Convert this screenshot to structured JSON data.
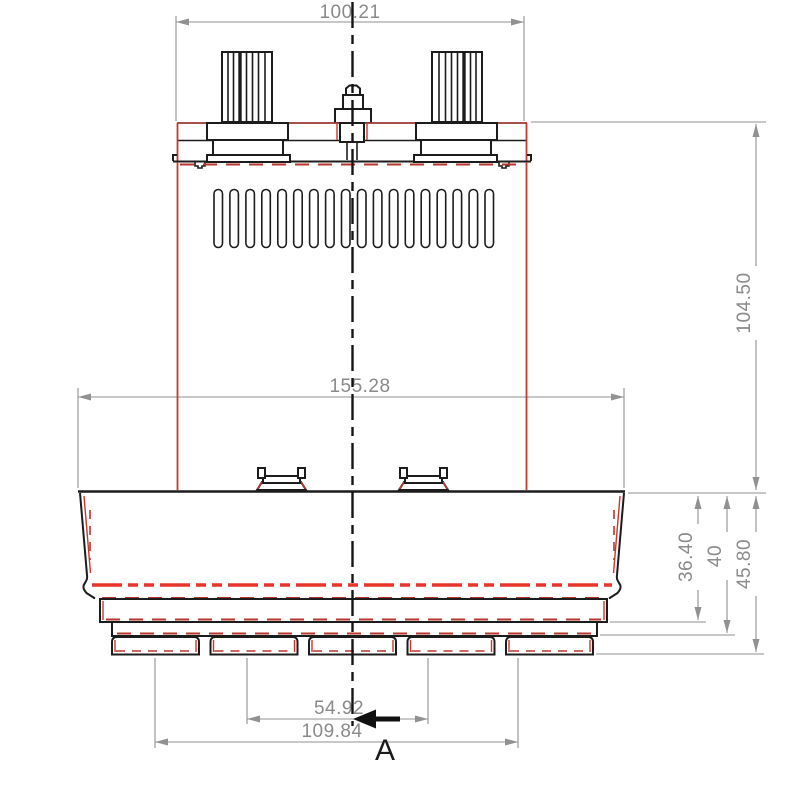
{
  "drawing": {
    "title": "Vacuum motor front-view technical drawing",
    "section_label": "A",
    "dimensions": {
      "top_width": "100.21",
      "housing_width": "155.28",
      "body_height": "104.50",
      "fan_step_1": "36.40",
      "fan_step_2": "40",
      "fan_step_3": "45.80",
      "foot_span_inner": "54.92",
      "foot_span_outer": "109.84"
    },
    "colors": {
      "outline_black": "#1c1c1c",
      "accent_red": "#c7372e",
      "hidden_red": "#b8362e",
      "centerline_red": "#e8352b",
      "dimension_gray": "#919191",
      "background": "#ffffff"
    }
  }
}
